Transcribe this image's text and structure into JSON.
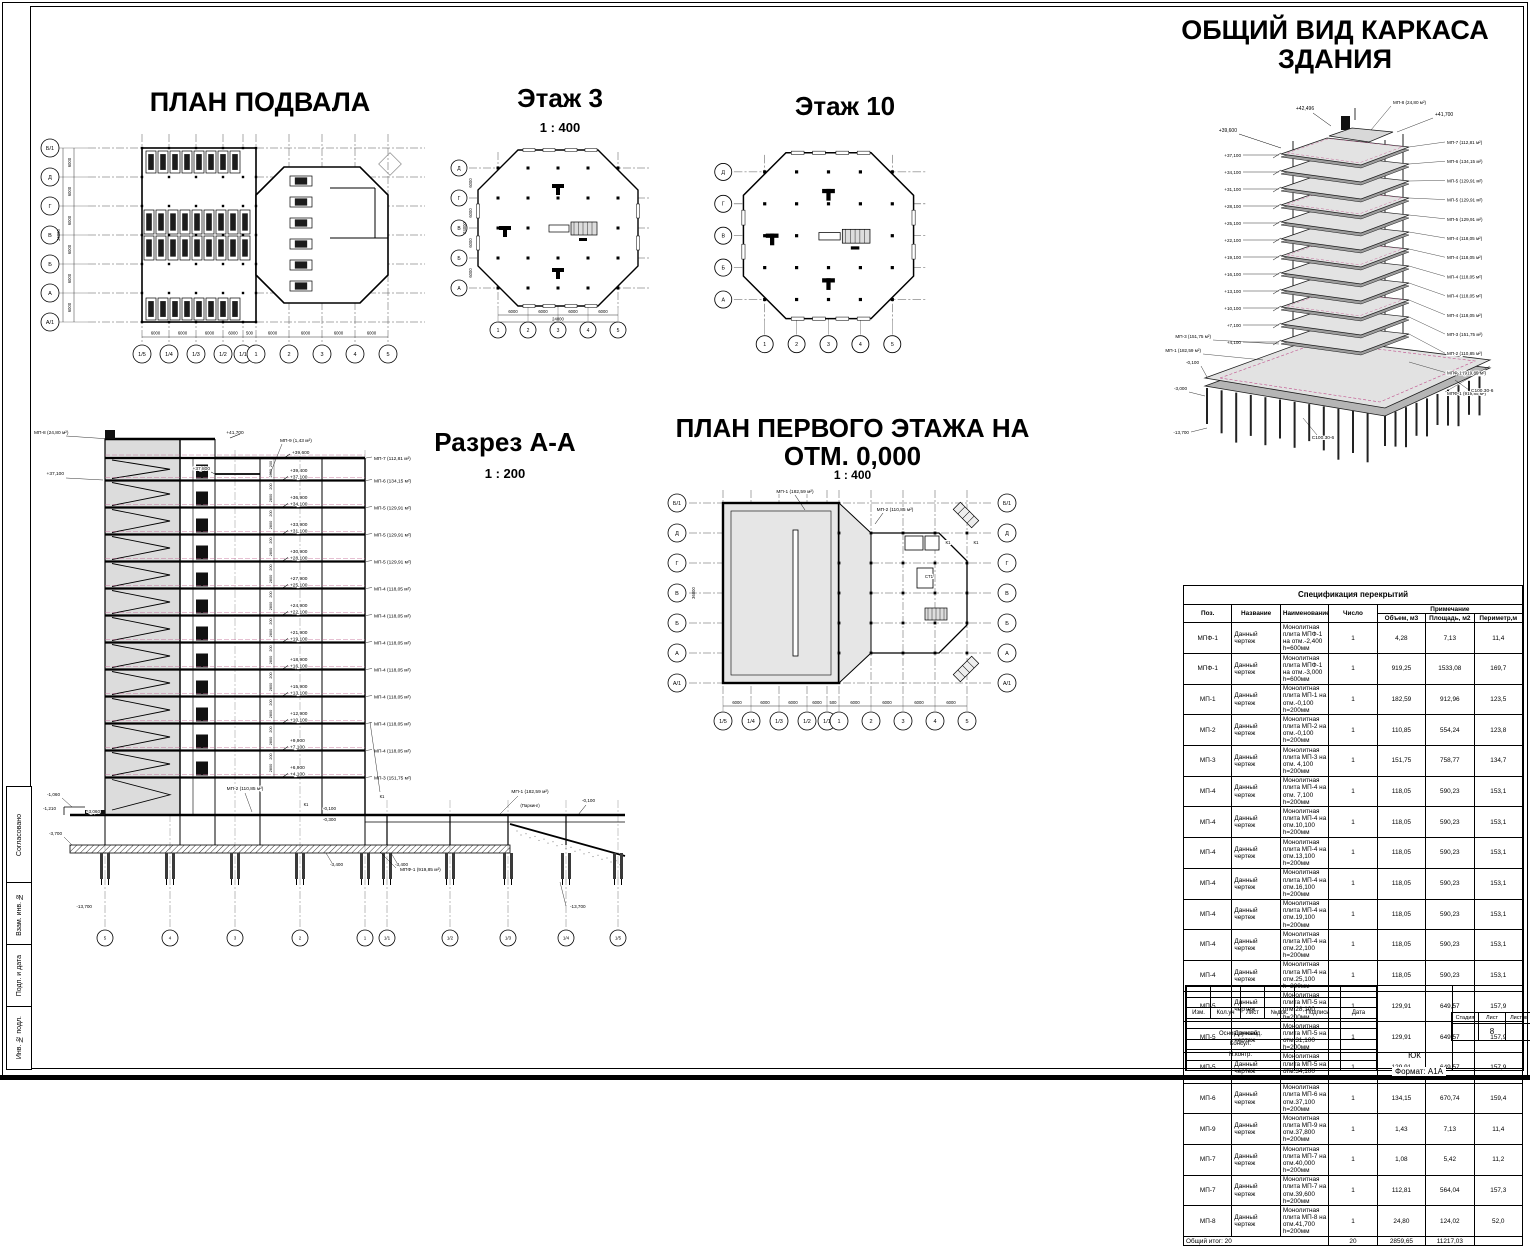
{
  "sheet": {
    "format_note": "Формат: А1А",
    "side_stamp": {
      "approved": "Согласовано",
      "vzam": "Взам. инв. №",
      "podp": "Подп. и дата",
      "inv": "Инв. № подл."
    }
  },
  "views": {
    "basement": {
      "title": "ПЛАН ПОДВАЛА",
      "row_axes": [
        "Б/1",
        "Д",
        "Г",
        "В",
        "Б",
        "А",
        "А/1"
      ],
      "col_axes": [
        "1/5",
        "1/4",
        "1/3",
        "1/2",
        "1/1",
        "1",
        "2",
        "3",
        "4",
        "5"
      ],
      "row_dims": [
        "6000",
        "6000",
        "6000",
        "6000",
        "6000",
        "6000"
      ],
      "row_total": "36000",
      "col_dims": [
        "6000",
        "6000",
        "6000",
        "6000",
        "500",
        "6000",
        "6000",
        "6000",
        "6000"
      ]
    },
    "floor3": {
      "title": "Этаж 3",
      "scale": "1 : 400",
      "row_axes": [
        "Д",
        "Г",
        "В",
        "Б",
        "А"
      ],
      "col_axes": [
        "1",
        "2",
        "3",
        "4",
        "5"
      ],
      "row_dims": [
        "6000",
        "6000",
        "6000",
        "6000"
      ],
      "row_total": "24000",
      "col_dims": [
        "6000",
        "6000",
        "6000",
        "6000"
      ],
      "col_total": "24000"
    },
    "floor10": {
      "title": "Этаж 10",
      "row_axes": [
        "Д",
        "Г",
        "В",
        "Б",
        "А"
      ],
      "col_axes": [
        "1",
        "2",
        "3",
        "4",
        "5"
      ]
    },
    "overview": {
      "title_line1": "ОБЩИЙ ВИД КАРКАСА",
      "title_line2": "ЗДАНИЯ",
      "top_elevations": [
        "+42,496",
        "+39,600"
      ],
      "plate_elevations": [
        "+37,100",
        "+34,100",
        "+31,100",
        "+28,100",
        "+25,100",
        "+22,100",
        "+19,100",
        "+16,100",
        "+13,100",
        "+10,100",
        "+7,100",
        "+4,100"
      ],
      "bottom_elevations": [
        "-0,100",
        "-3,000",
        "-13,700"
      ],
      "right_labels": [
        "МП-8 (24,80 м²)",
        "+41,700",
        "МП-7 (112,81 м²)",
        "МП-6 (134,15 м²)",
        "МП-5 (129,91 м²)",
        "МП-5 (129,91 м²)",
        "МП-5 (129,91 м²)",
        "МП-4 (118,05 м²)",
        "МП-4 (118,05 м²)",
        "МП-4 (118,05 м²)",
        "МП-4 (118,05 м²)",
        "МП-4 (118,05 м²)",
        "МП-3 (151,75 м²)",
        "МП-2 (110,85 м²)",
        "МПФ-1 (919,85 м²)"
      ],
      "mid_labels": [
        "МП-3 (151,75 м²)",
        "МП-1 (182,59 м²)"
      ],
      "pile_label": "С100.30-6"
    },
    "section": {
      "title": "Разрез А-А",
      "scale": "1 : 200",
      "top_elevation": "+39,600",
      "pairs": [
        [
          "+39,400",
          "+37,100"
        ],
        [
          "+36,900",
          "+34,100"
        ],
        [
          "+33,900",
          "+31,100"
        ],
        [
          "+30,900",
          "+28,100"
        ],
        [
          "+27,900",
          "+25,100"
        ],
        [
          "+24,900",
          "+22,100"
        ],
        [
          "+21,900",
          "+19,100"
        ],
        [
          "+18,900",
          "+16,100"
        ],
        [
          "+15,900",
          "+13,100"
        ],
        [
          "+12,900",
          "+10,100"
        ],
        [
          "+9,900",
          "+7,100"
        ],
        [
          "+6,900",
          "+4,100"
        ]
      ],
      "right_labels": [
        "МП-7 (112,81 м²)",
        "МП-6 (134,15 м²)",
        "МП-5 (129,91 м²)",
        "МП-5 (129,91 м²)",
        "МП-5 (129,91 м²)",
        "МП-4 (118,05 м²)",
        "МП-4 (118,05 м²)",
        "МП-4 (118,05 м²)",
        "МП-4 (118,05 м²)",
        "МП-4 (118,05 м²)",
        "МП-4 (118,05 м²)",
        "МП-4 (118,05 м²)",
        "МП-3 (151,75 м²)"
      ],
      "top_labels": {
        "mp8": "МП-8 (24,80 м²)",
        "e41700": "+41,700",
        "e37800": "+37,800",
        "e37100": "+37,100",
        "mp9": "МП-9 (1,43 м²)"
      },
      "low_labels": {
        "m0100": "-0,100",
        "m0300": "-0,300",
        "m0100r": "-0,100",
        "m1060": "-1,060",
        "m1210": "-1,210",
        "m3060": "-3,060",
        "m3400a": "-3,400",
        "m3400b": "-3,400",
        "m3700": "-3,700",
        "m13700l": "-13,700",
        "m13700r": "-13,700",
        "mp2": "МП-2 (110,85 м²)",
        "mp1": "МП-1 (182,59 м²)",
        "mpf1": "МПФ-1 (919,85 м²)",
        "parking": "(Паркинг)",
        "k1a": "К1",
        "k1b": "К1"
      },
      "floor_dim": "2800",
      "slab_dim": "200",
      "col_axes": [
        "5",
        "4",
        "3",
        "2",
        "1",
        "1/1",
        "1/2",
        "1/3",
        "1/4",
        "1/5"
      ]
    },
    "first_floor": {
      "title_line1": "ПЛАН ПЕРВОГО ЭТАЖА НА",
      "title_line2": "ОТМ. 0,000",
      "scale": "1 : 400",
      "row_axes": [
        "Б/1",
        "Д",
        "Г",
        "В",
        "Б",
        "А",
        "А/1"
      ],
      "col_axes": [
        "1/5",
        "1/4",
        "1/3",
        "1/2",
        "1/1",
        "1",
        "2",
        "3",
        "4",
        "5"
      ],
      "col_dims": [
        "6000",
        "6000",
        "6000",
        "6000",
        "500",
        "6000",
        "6000",
        "6000",
        "6000"
      ],
      "row_total": "36000",
      "labels": {
        "mp1": "МП-1 (182,59 м²)",
        "mp2": "МП-2 (110,85 м²)",
        "k1a": "К1",
        "k1b": "К1",
        "st1": "СТ1"
      }
    }
  },
  "spec_table": {
    "title": "Спецификация перекрытий",
    "headers": {
      "pos": "Поз.",
      "designation": "Название",
      "name": "Наименование",
      "count": "Число",
      "note": "Примечание",
      "volume": "Объем, м3",
      "area": "Площадь, м2",
      "perimeter": "Периметр,м"
    },
    "rows": [
      [
        "МПФ-1",
        "Данный чертеж",
        "Монолитная плита МПФ-1 на отм.-2,400 h=600мм",
        "1",
        "4,28",
        "7,13",
        "11,4"
      ],
      [
        "МПФ-1",
        "Данный чертеж",
        "Монолитная плита МПФ-1 на отм.-3,000 h=600мм",
        "1",
        "919,25",
        "1533,08",
        "169,7"
      ],
      [
        "МП-1",
        "Данный чертеж",
        "Монолитная плита МП-1 на отм.-0,100 h=200мм",
        "1",
        "182,59",
        "912,96",
        "123,5"
      ],
      [
        "МП-2",
        "Данный чертеж",
        "Монолитная плита МП-2 на отм.-0,100 h=200мм",
        "1",
        "110,85",
        "554,24",
        "123,8"
      ],
      [
        "МП-3",
        "Данный чертеж",
        "Монолитная плита МП-3 на отм. 4,100 h=200мм",
        "1",
        "151,75",
        "758,77",
        "134,7"
      ],
      [
        "МП-4",
        "Данный чертеж",
        "Монолитная плита МП-4 на отм. 7,100 h=200мм",
        "1",
        "118,05",
        "590,23",
        "153,1"
      ],
      [
        "МП-4",
        "Данный чертеж",
        "Монолитная плита МП-4 на отм.10,100 h=200мм",
        "1",
        "118,05",
        "590,23",
        "153,1"
      ],
      [
        "МП-4",
        "Данный чертеж",
        "Монолитная плита МП-4 на отм.13,100 h=200мм",
        "1",
        "118,05",
        "590,23",
        "153,1"
      ],
      [
        "МП-4",
        "Данный чертеж",
        "Монолитная плита МП-4 на отм.16,100 h=200мм",
        "1",
        "118,05",
        "590,23",
        "153,1"
      ],
      [
        "МП-4",
        "Данный чертеж",
        "Монолитная плита МП-4 на отм.19,100 h=200мм",
        "1",
        "118,05",
        "590,23",
        "153,1"
      ],
      [
        "МП-4",
        "Данный чертеж",
        "Монолитная плита МП-4 на отм.22,100 h=200мм",
        "1",
        "118,05",
        "590,23",
        "153,1"
      ],
      [
        "МП-4",
        "Данный чертеж",
        "Монолитная плита МП-4 на отм.25,100 h=200мм",
        "1",
        "118,05",
        "590,23",
        "153,1"
      ],
      [
        "МП-5",
        "Данный чертеж",
        "Монолитная плита МП-5 на отм.28,100 h=200мм",
        "1",
        "129,91",
        "649,57",
        "157,9"
      ],
      [
        "МП-5",
        "Данный чертеж",
        "Монолитная плита МП-5 на отм.31,100 h=200мм",
        "1",
        "129,91",
        "649,57",
        "157,9"
      ],
      [
        "МП-5",
        "Данный чертеж",
        "Монолитная плита МП-5 на отм.34,100 h=200мм",
        "1",
        "129,91",
        "649,57",
        "157,9"
      ],
      [
        "МП-6",
        "Данный чертеж",
        "Монолитная плита МП-6 на отм.37,100 h=200мм",
        "1",
        "134,15",
        "670,74",
        "159,4"
      ],
      [
        "МП-9",
        "Данный чертеж",
        "Монолитная плита МП-9 на отм.37,800 h=200мм",
        "1",
        "1,43",
        "7,13",
        "11,4"
      ],
      [
        "МП-7",
        "Данный чертеж",
        "Монолитная плита МП-7 на отм.40,000 h=200мм",
        "1",
        "1,08",
        "5,42",
        "11,2"
      ],
      [
        "МП-7",
        "Данный чертеж",
        "Монолитная плита МП-7 на отм.39,600 h=200мм",
        "1",
        "112,81",
        "564,04",
        "157,3"
      ],
      [
        "МП-8",
        "Данный чертеж",
        "Монолитная плита МП-8 на отм.41,700 h=200мм",
        "1",
        "24,80",
        "124,02",
        "52,0"
      ]
    ],
    "total": {
      "label": "Общий итог: 20",
      "count": "20",
      "volume": "2859,65",
      "area": "11217,03"
    }
  },
  "title_block": {
    "rev_headers": [
      "Изм.",
      "Кол.уч",
      "Лист",
      "№док.",
      "Подпись",
      "Дата"
    ],
    "sign_rows": [
      "Основ.руковод.",
      "Консул.",
      "Н.контр."
    ],
    "doc_mark": "ЮК",
    "stage_headers": [
      "Стадия",
      "Лист",
      "Листов"
    ],
    "sheet_number": "8"
  }
}
